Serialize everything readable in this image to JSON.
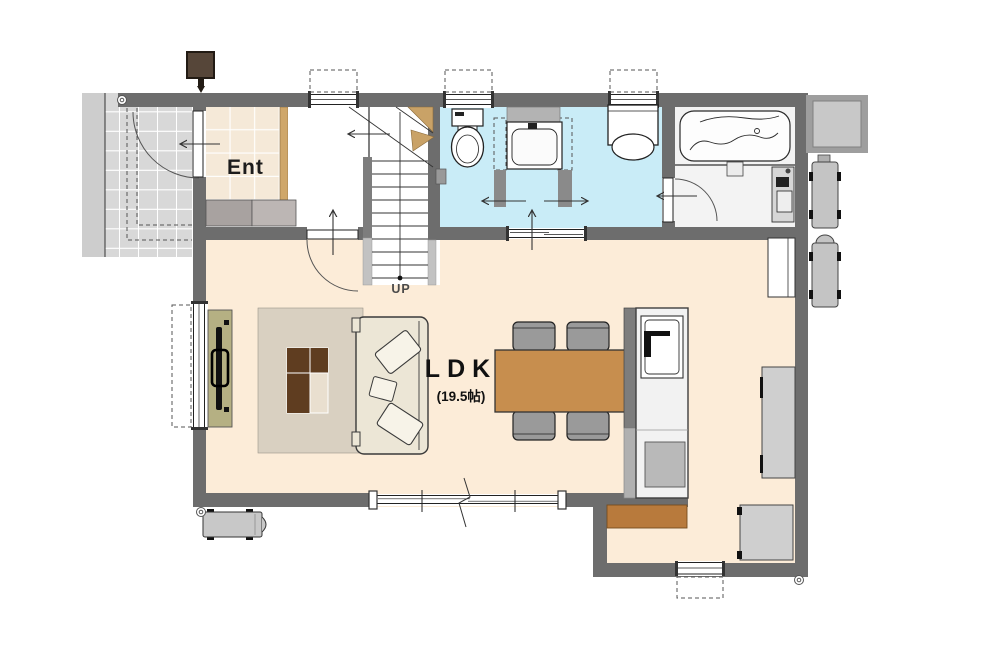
{
  "plan": {
    "rooms": {
      "entrance": {
        "label": "Ent"
      },
      "ldk": {
        "label": "LDK",
        "area": "(19.5帖)"
      },
      "stairs": {
        "direction_label": "UP"
      }
    }
  },
  "colors": {
    "wall": "#6d6d6d",
    "wall_stub": "#8a8a8a",
    "ldk_floor": "#fcecd8",
    "ent_floor": "#f5e9d8",
    "wet_floor": "#c9ecf7",
    "bath_floor": "#f3f3f3",
    "porch": "#d8d8d8",
    "porch_strip": "#cdcdcd",
    "rug": "#d9d0c1",
    "sofa": "#ece6d6",
    "pillow": "#f7f3e8",
    "tv_board": "#b5b083",
    "table_dark": "#5f3d20",
    "table_light": "#e9dfcf",
    "dining_table": "#c78e4e",
    "chair": "#9a9a9a",
    "island": "#f2f2f2",
    "stove": "#b9b9b9",
    "counter": "#cfcfcf",
    "cupboard": "#b87a3c",
    "wood_trim": "#cfa76a",
    "marker_brown": "#564639",
    "winder": "#c9a267"
  }
}
